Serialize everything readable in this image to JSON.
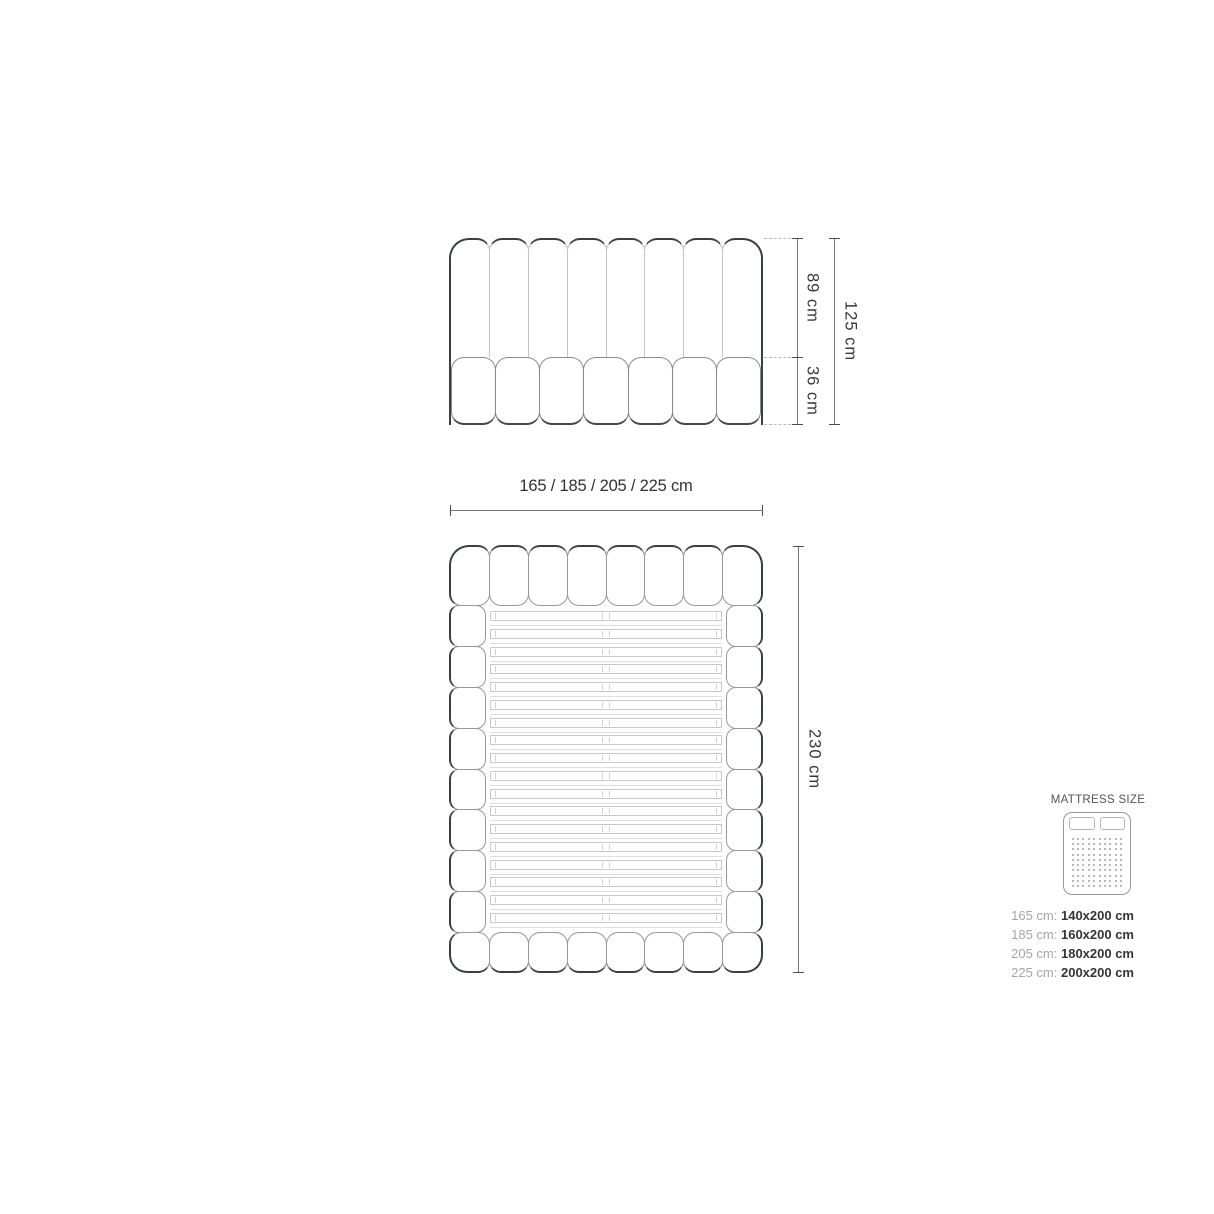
{
  "counts": {
    "front_channels": 8,
    "front_cushions": 7,
    "plan_tufts_top": 8,
    "plan_tufts_bottom": 8,
    "plan_rail_segments": 8,
    "plan_slats": 18,
    "mattress_dots": 100,
    "mattress_pillows": 2
  },
  "dimensions": {
    "front_upper_height": "89 cm",
    "front_lower_height": "36 cm",
    "front_total_height": "125 cm",
    "width_options": "165 / 185 / 205 / 225 cm",
    "plan_length": "230 cm"
  },
  "legend": {
    "title": "MATTRESS SIZE",
    "rows": [
      {
        "label": "165 cm:",
        "value": "140x200 cm"
      },
      {
        "label": "185 cm:",
        "value": "160x200 cm"
      },
      {
        "label": "205 cm:",
        "value": "180x200 cm"
      },
      {
        "label": "225 cm:",
        "value": "200x200 cm"
      }
    ]
  },
  "colors": {
    "outline_dark": "#3c3f41",
    "line_gray": "#96989a",
    "line_light": "#c6c8ca",
    "dimension_line": "#737577",
    "dimension_text": "#36383a",
    "legend_label_gray": "#a3a5a7",
    "legend_value_dark": "#333537",
    "background": "#ffffff"
  }
}
